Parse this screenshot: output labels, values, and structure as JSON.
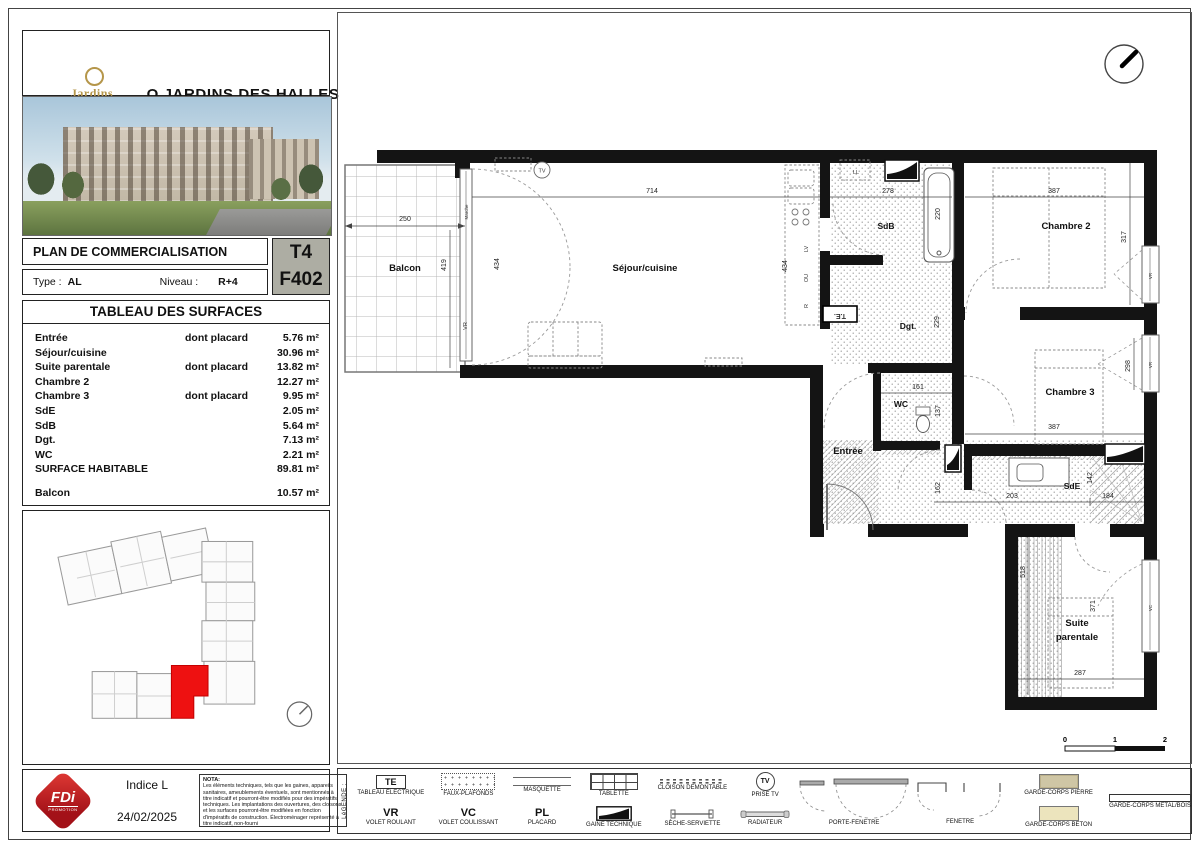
{
  "header": {
    "logo_line1": "Jardins",
    "logo_line2": "des Halles",
    "title": "O JARDINS DES HALLES"
  },
  "info": {
    "plan_label": "PLAN DE COMMERCIALISATION",
    "type_label": "Type :",
    "type_value": "AL",
    "niveau_label": "Niveau :",
    "niveau_value": "R+4",
    "unit_type": "T4",
    "unit_number": "F402"
  },
  "surfaces": {
    "title": "TABLEAU DES SURFACES",
    "rows": [
      {
        "name": "Entrée",
        "note": "dont placard",
        "value": "5.76 m²"
      },
      {
        "name": "Séjour/cuisine",
        "note": "",
        "value": "30.96 m²"
      },
      {
        "name": "Suite parentale",
        "note": "dont placard",
        "value": "13.82 m²"
      },
      {
        "name": "Chambre 2",
        "note": "",
        "value": "12.27 m²"
      },
      {
        "name": "Chambre 3",
        "note": "dont placard",
        "value": "9.95 m²"
      },
      {
        "name": "SdE",
        "note": "",
        "value": "2.05 m²"
      },
      {
        "name": "SdB",
        "note": "",
        "value": "5.64 m²"
      },
      {
        "name": "Dgt.",
        "note": "",
        "value": "7.13 m²"
      },
      {
        "name": "WC",
        "note": "",
        "value": "2.21 m²"
      },
      {
        "name": "SURFACE HABITABLE",
        "note": "",
        "value": "89.81 m²"
      },
      {
        "name": "Balcon",
        "note": "",
        "value": "10.57 m²"
      }
    ]
  },
  "footer": {
    "fdi_text": "FDi",
    "fdi_sub": "PROMOTION",
    "indice": "Indice L",
    "date": "24/02/2025",
    "nota_title": "NOTA:",
    "nota_text": "Les éléments techniques, tels que les gaines, appareils sanitaires, ameublements éventuels, sont mentionnés à titre indicatif et pourront-être modifiés pour des impératifs techniques. Les implantations des ouvertures, des cloisons et les surfaces pourront-être modifiées en fonction d'impératifs de construction. Électroménager représenté à titre indicatif, non-fourni"
  },
  "legend": {
    "title": "LéGENDE :",
    "te_sym": "TE",
    "te": "TABLEAU ÉLECTRIQUE",
    "faux": "FAUX-PLAFONDS",
    "masquette": "MASQUETTE",
    "tablette": "TABLETTE",
    "cloison": "CLOISON DEMONTABLE",
    "prise_tv_sym": "TV",
    "prise_tv": "PRISE TV",
    "vr_sym": "VR",
    "vr": "VOLET ROULANT",
    "vc_sym": "VC",
    "vc": "VOLET COULISSANT",
    "pl_sym": "PL",
    "pl": "PLACARD",
    "gaine": "GAINE TECHNIQUE",
    "seche": "SÈCHE-SERVIETTE",
    "radiateur": "RADIATEUR",
    "porte_fenetre": "PORTE-FENETRE",
    "fenetre": "FENETRE",
    "gc_pierre": "GARDE-CORPS PIERRE",
    "gc_beton": "GARDE-CORPS BETON",
    "gc_metal": "GARDE-CORPS METAL/BOIS"
  },
  "plan": {
    "rooms": {
      "balcon": "Balcon",
      "sejour": "Séjour/cuisine",
      "sdb": "SdB",
      "dgt": "Dgt.",
      "wc": "WC",
      "entree": "Entrée",
      "chambre2": "Chambre 2",
      "chambre3": "Chambre 3",
      "sde": "SdE",
      "suite1": "Suite",
      "suite2": "parentale"
    },
    "dims": {
      "d250": "250",
      "d419": "419",
      "d434a": "434",
      "d434b": "434",
      "d714": "714",
      "d278": "278",
      "d220": "220",
      "d387a": "387",
      "d317": "317",
      "d229": "229",
      "d161": "161",
      "d137": "137",
      "d162": "162",
      "d203": "203",
      "d184": "184",
      "d387b": "387",
      "d298": "298",
      "d142": "142",
      "d518": "518",
      "d371": "371",
      "d287": "287"
    },
    "tags": {
      "marche": "Marche",
      "vr": "VR",
      "vc": "VC",
      "ll": "LL",
      "lv": "LV",
      "ou": "OU",
      "r": "R",
      "te": "T.E.",
      "tv": "TV"
    },
    "scale": {
      "s0": "0",
      "s1": "1",
      "s2": "2"
    }
  }
}
